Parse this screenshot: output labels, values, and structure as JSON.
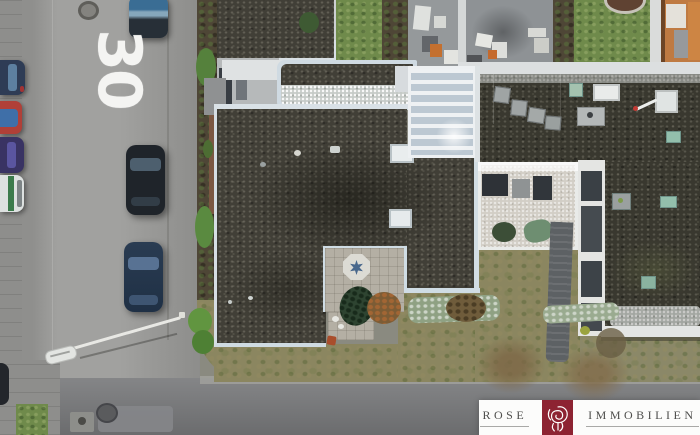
{
  "scene": {
    "type": "aerial drone photograph",
    "setting": "residential street corner with flat-roof bungalows, gardens, glazed atrium and parked cars"
  },
  "road": {
    "marking_text": "30",
    "marking_color": "#f4f4f2"
  },
  "logo": {
    "left_word": "ROSE",
    "right_word": "IMMOBILIEN",
    "brand_color": "#8d2332",
    "band_color": "#fcfcfb",
    "text_color": "#4e4e4c",
    "icon": "rose-flower-icon"
  },
  "colors": {
    "asphalt_vertical_road": "#9d9d9b",
    "asphalt_cross_road": "#7a7b7d",
    "roof_gravel_dark": "#403e36",
    "parapet_pale_blue": "#d7dfe5",
    "lawn_green": "#6f8a4b",
    "winter_grass": "#8b8660",
    "patio_tile": "#b4afa4",
    "star_inlay_blue": "#49688c",
    "frost_white": "#c6cbc8"
  },
  "objects": {
    "parked_cars_left_row": [
      {
        "name": "dark-blue car",
        "color": "#2e3c55"
      },
      {
        "name": "red car with blue tarp",
        "color": "#b04038"
      },
      {
        "name": "purple car",
        "color": "#393363"
      },
      {
        "name": "white car with green stripe",
        "color": "#dde1e0"
      }
    ],
    "cars_on_street": [
      {
        "name": "blue-roof car top",
        "color": "#3a6d94"
      },
      {
        "name": "black car middle",
        "color": "#1f242a"
      },
      {
        "name": "dark-blue car near corner",
        "color": "#2a3c52"
      }
    ],
    "street_lamp": "white lamp post leaning over the corner",
    "patio_feature": "octagonal paving circle with blue star inlay"
  }
}
